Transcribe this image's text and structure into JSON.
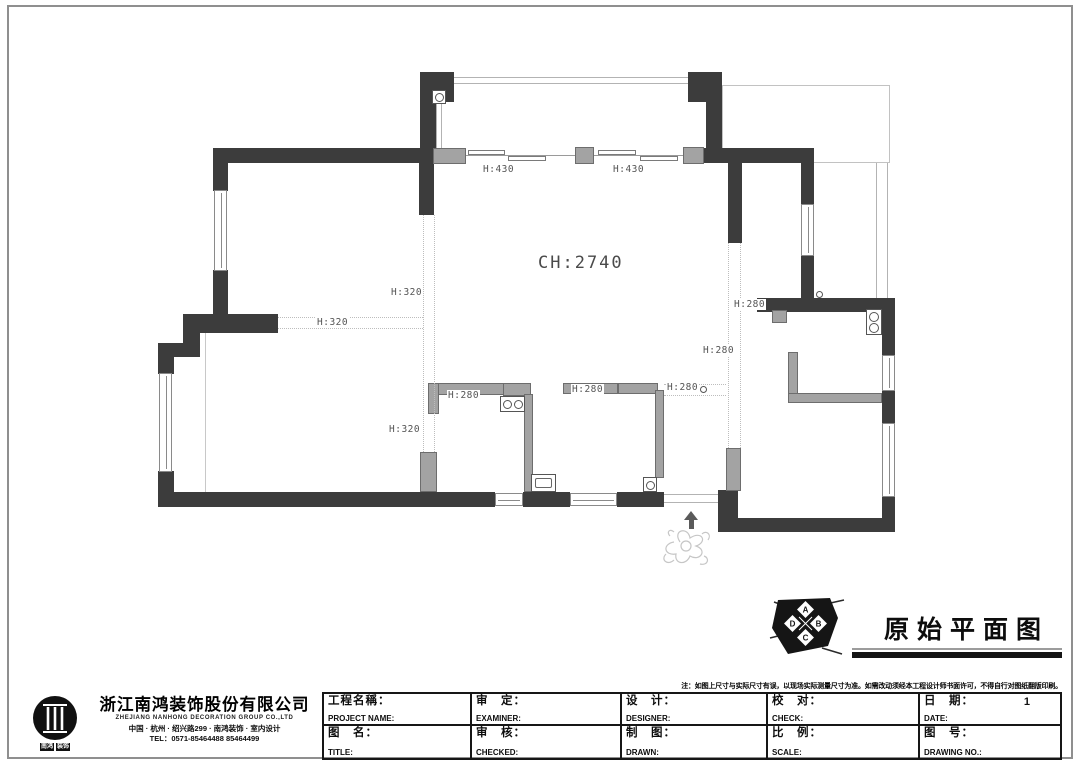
{
  "plan": {
    "labels": [
      {
        "text": "H:430"
      },
      {
        "text": "H:430"
      },
      {
        "text": "CH:2740"
      },
      {
        "text": "H:320"
      },
      {
        "text": "H:320"
      },
      {
        "text": "H:320"
      },
      {
        "text": "H:280"
      },
      {
        "text": "H:280"
      },
      {
        "text": "H:280"
      },
      {
        "text": "H:280"
      },
      {
        "text": "H:280"
      }
    ]
  },
  "drawing_title": {
    "text": "原始平面图",
    "logo_letters": [
      "A",
      "B",
      "C",
      "D"
    ]
  },
  "title_block": {
    "note": "注：如图上尺寸与实际尺寸有误，以现场实际测量尺寸为准。如需改动须经本工程设计师书面许可，不得自行对图纸翻版印刷。",
    "company": {
      "name": "浙江南鸿装饰股份有限公司",
      "name_en": "ZHEJIANG NANHONG DECORATION GROUP CO.,LTD",
      "services": "中国 · 杭州 · 绍兴路299 · 南鸿装饰 · 室内设计",
      "tel": "TEL：0571-85464488 85464499",
      "logo_badges": [
        "南鸿",
        "装饰"
      ]
    },
    "fields": {
      "project_cn": "工程名稱：",
      "project_en": "PROJECT NAME:",
      "examine_cn": "审　定：",
      "examine_en": "EXAMINER:",
      "design_cn": "设　计：",
      "design_en": "DESIGNER:",
      "check_cn": "校　对：",
      "check_en": "CHECK:",
      "date_cn": "日　期：",
      "date_en": "DATE:",
      "date_value": "1",
      "name_cn": "图　名：",
      "name_en": "TITLE:",
      "review_cn": "审　核：",
      "review_en": "CHECKED:",
      "drawn_cn": "制　图：",
      "drawn_en": "DRAWN:",
      "scale_cn": "比　例：",
      "scale_en": "SCALE:",
      "no_cn": "图　号：",
      "no_en": "DRAWING NO.:"
    }
  }
}
